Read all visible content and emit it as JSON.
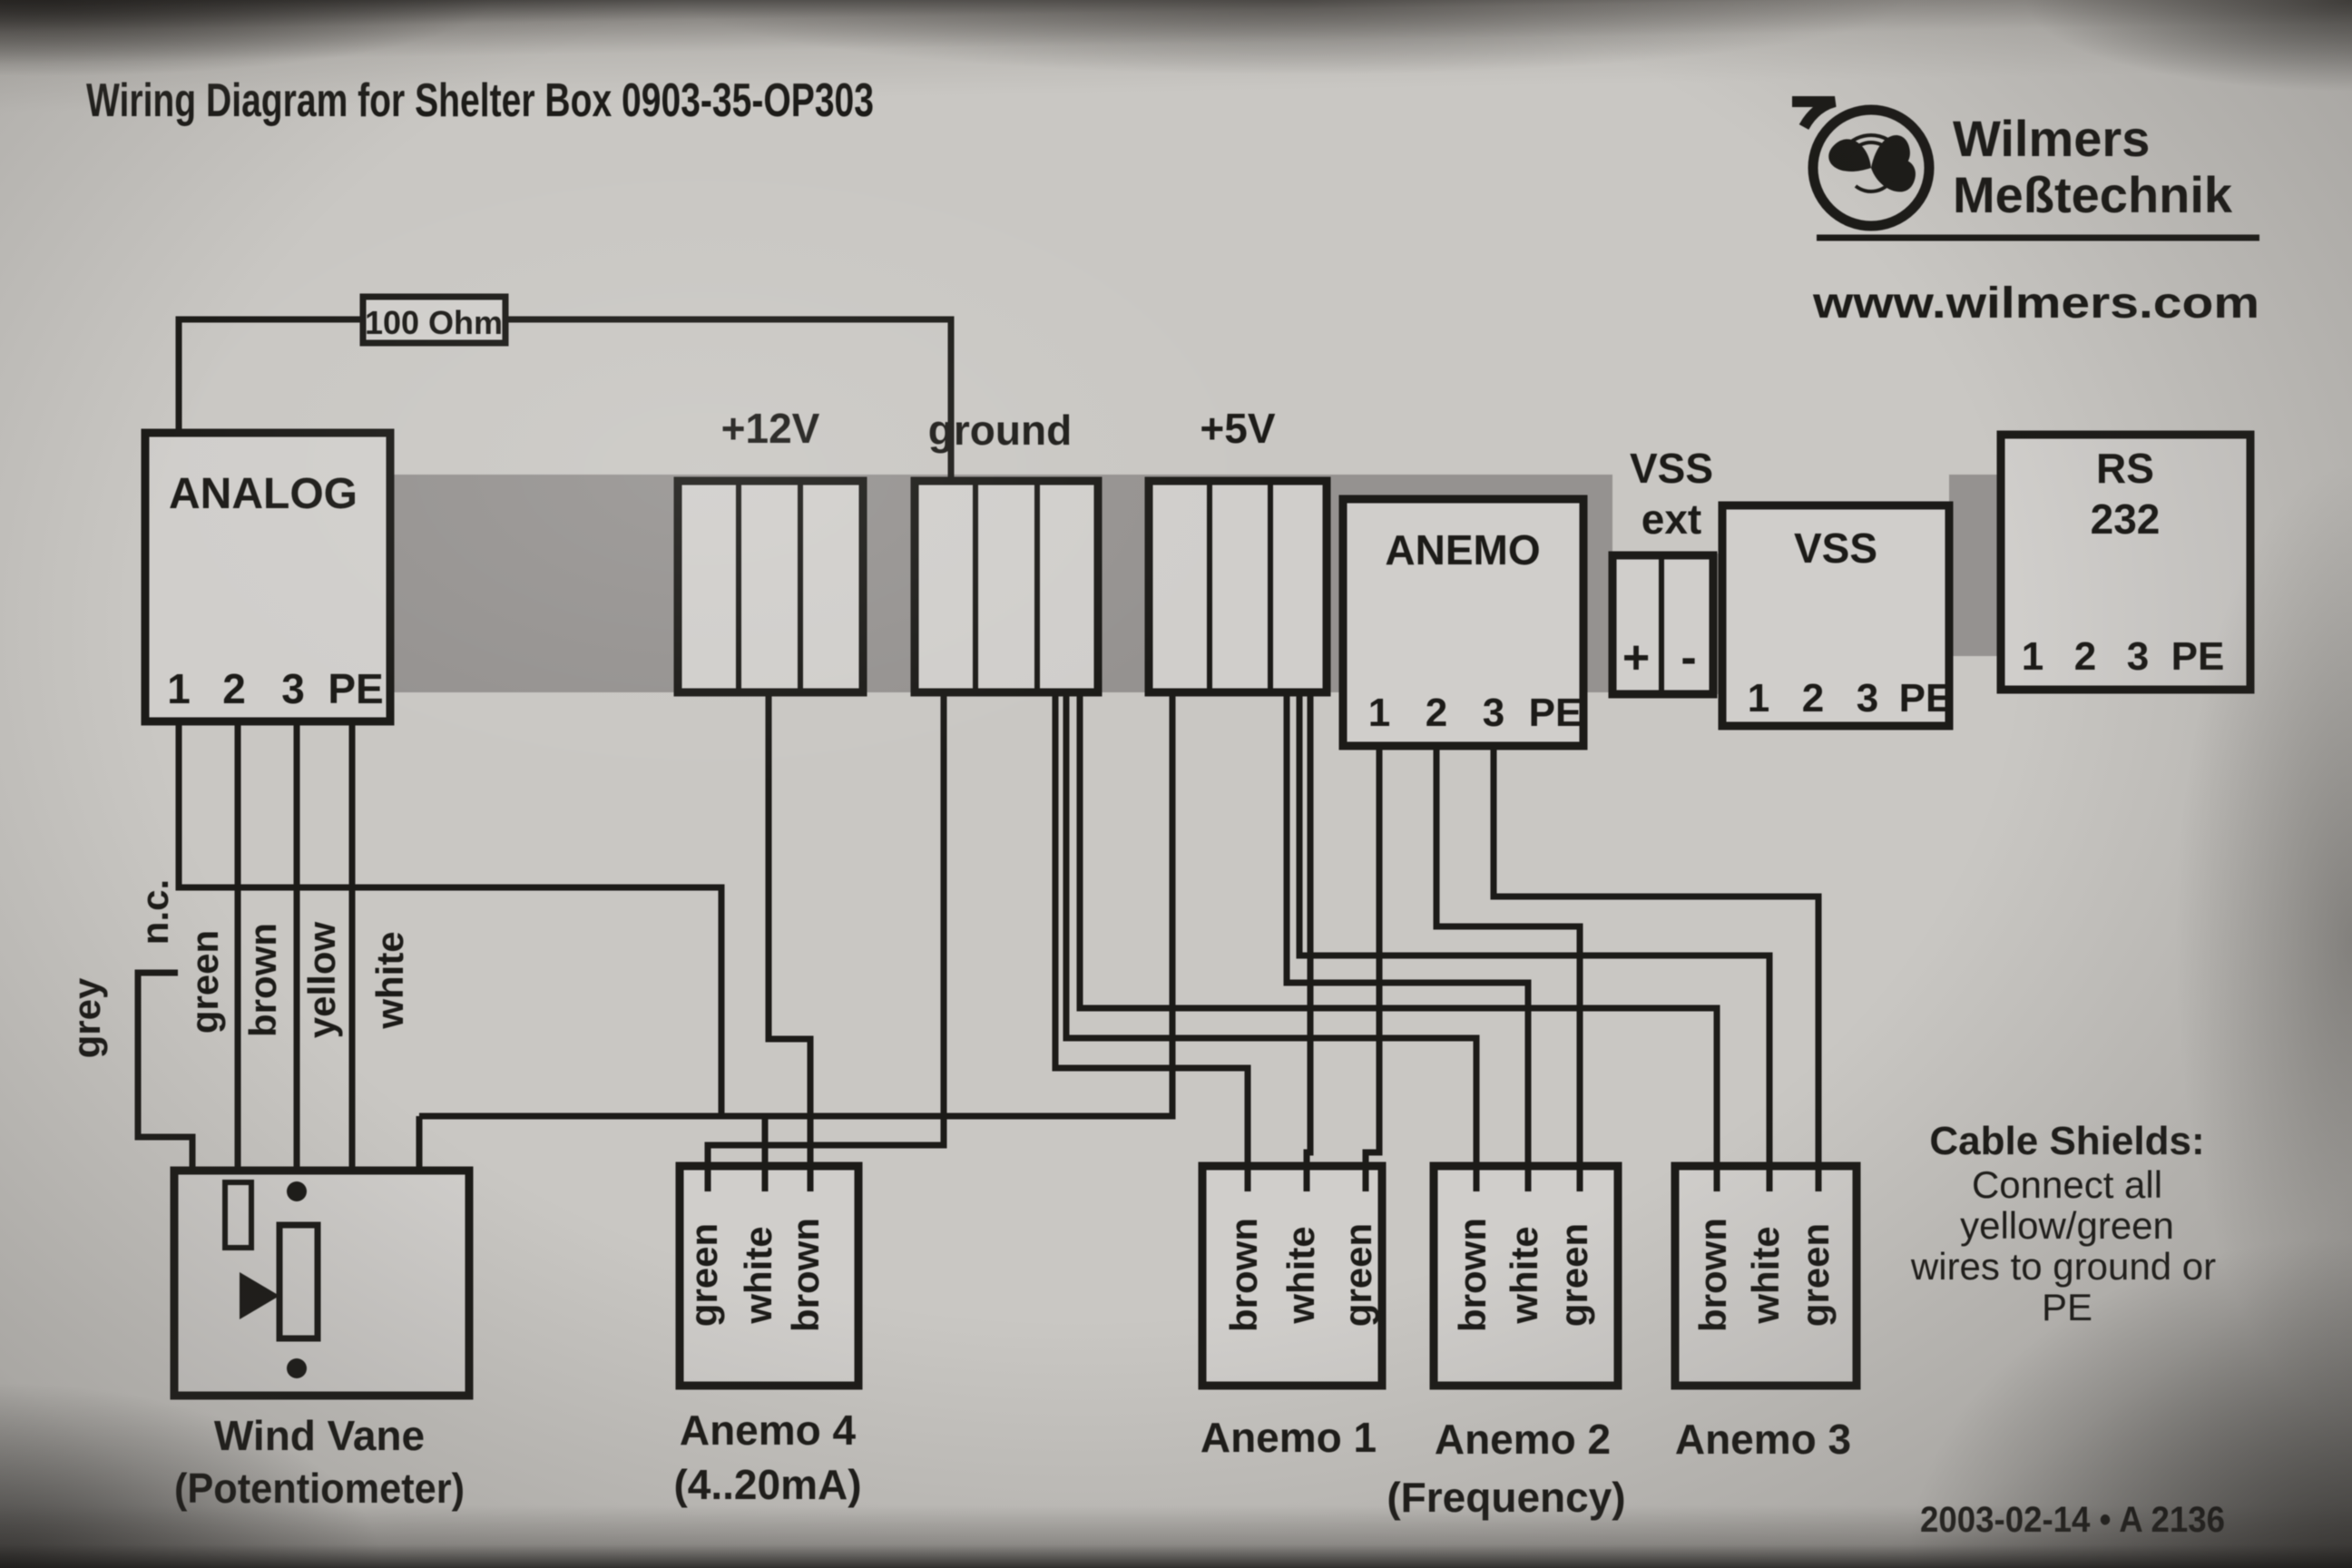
{
  "title": "Wiring Diagram for Shelter Box 0903-35-OP303",
  "logo": {
    "icon": "anemometer-propeller-logo-icon",
    "name_line1": "Wilmers",
    "name_line2": "Meßtechnik",
    "website": "www.wilmers.com"
  },
  "resistor": {
    "label": "100 Ohm"
  },
  "blocks": {
    "analog": {
      "label": "ANALOG",
      "terminals": [
        "1",
        "2",
        "3",
        "PE"
      ]
    },
    "plus12v": {
      "label": "+12V"
    },
    "ground": {
      "label": "ground"
    },
    "plus5v": {
      "label": "+5V"
    },
    "anemo": {
      "label": "ANEMO",
      "terminals": [
        "1",
        "2",
        "3",
        "PE"
      ]
    },
    "vss_ext": {
      "label_line1": "VSS",
      "label_line2": "ext",
      "plus": "+",
      "minus": "-"
    },
    "vss": {
      "label": "VSS",
      "terminals": [
        "1",
        "2",
        "3",
        "PE"
      ]
    },
    "rs232": {
      "label_line1": "RS",
      "label_line2": "232",
      "terminals": [
        "1",
        "2",
        "3",
        "PE"
      ]
    }
  },
  "wind_vane": {
    "wire_grey": "grey",
    "wire_nc": "n.c.",
    "wire_green": "green",
    "wire_brown": "brown",
    "wire_yellow": "yellow",
    "wire_white": "white",
    "caption_line1": "Wind Vane",
    "caption_line2": "(Potentiometer)"
  },
  "anemo4": {
    "wires": [
      "green",
      "white",
      "brown"
    ],
    "caption_line1": "Anemo 4",
    "caption_line2": "(4..20mA)"
  },
  "anemo1": {
    "wires": [
      "brown",
      "white",
      "green"
    ],
    "caption": "Anemo 1"
  },
  "anemo2": {
    "wires": [
      "brown",
      "white",
      "green"
    ],
    "caption": "Anemo 2",
    "caption_line2": "(Frequency)"
  },
  "anemo3": {
    "wires": [
      "brown",
      "white",
      "green"
    ],
    "caption": "Anemo 3"
  },
  "cable_shields": {
    "heading": "Cable Shields:",
    "line1": "Connect all",
    "line2": "yellow/green",
    "line3": "wires to ground or",
    "line4": "PE"
  },
  "footer": {
    "date_ref": "2003-02-14 • A 2136"
  },
  "colors": {
    "ink": "#1c1b18",
    "paper": "#c9c7c3",
    "block_fill": "#d0cecb",
    "bus_gray": "#959290"
  }
}
